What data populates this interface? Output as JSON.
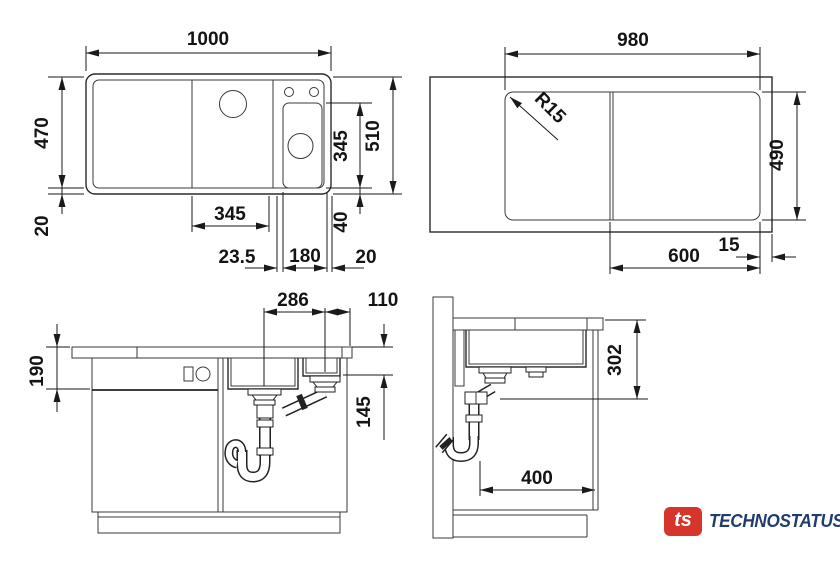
{
  "drawing": {
    "type": "sink installation dimension drawing",
    "views": {
      "sink_plan": {
        "label": "sink plan view",
        "dims": {
          "overall_width": "1000",
          "depth": "470",
          "front_rim": "20",
          "overall_depth": "510",
          "bowl_length": "345",
          "rear_rim": "40",
          "bowl_width": "345",
          "bowl_offset": "23.5",
          "small_bowl_width": "180",
          "edge_gap": "20"
        }
      },
      "cutout_plan": {
        "label": "worktop cutout plan view",
        "dims": {
          "cutout_width": "980",
          "corner_radius": "R15",
          "cutout_depth": "490",
          "edge_distance": "15",
          "drainer_width": "600"
        }
      },
      "front_section": {
        "label": "front section view",
        "dims": {
          "drain_spacing": "286",
          "drain_to_edge": "110",
          "bowl_depth": "190",
          "small_bowl_depth": "145"
        }
      },
      "side_section": {
        "label": "side section view",
        "dims": {
          "underside_clearance": "302",
          "trap_clearance": "400"
        }
      }
    },
    "line_color": "#222222"
  },
  "logo": {
    "badge_text": "ts",
    "brand_name": "TECHNOSTATUS",
    "badge_color": "#d5352b",
    "text_color": "#1e3c6e"
  }
}
